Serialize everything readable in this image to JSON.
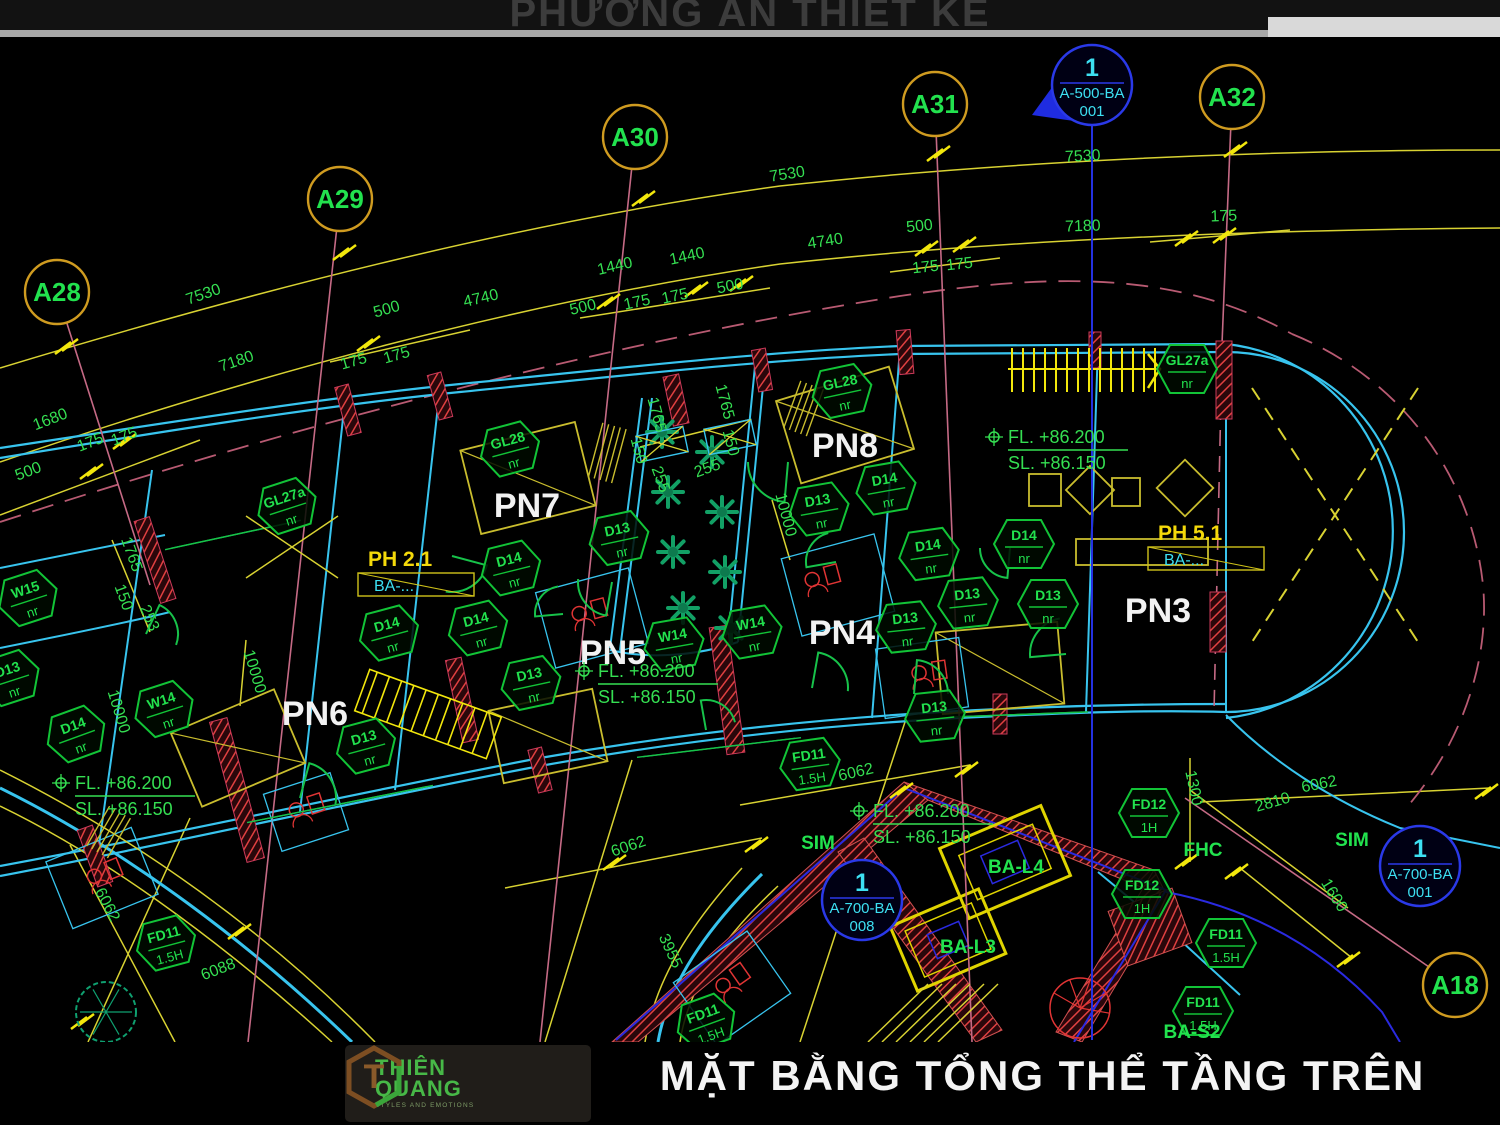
{
  "header": {
    "title": "PHƯƠNG ÁN THIẾT KẾ"
  },
  "footer": {
    "brand_line1": "THIÊN",
    "brand_line2": "QUANG",
    "tagline": "STYLES AND EMOTIONS",
    "monogram": "T",
    "title": "MẶT BẰNG TỔNG THỂ TẦNG TRÊN"
  },
  "colors": {
    "bg": "#000000",
    "green": "#22e24e",
    "dimGreen": "#35df52",
    "yellow": "#d8d232",
    "brightYellow": "#f2e70c",
    "cyanWall": "#38c4ee",
    "blue": "#2431e0",
    "cyanText": "#3de0f2",
    "pink": "#c56a85",
    "red": "#e03434",
    "white": "#f2f2f2",
    "bubble": "#cf9b20",
    "hex": "#12c437",
    "phYellow": "#f4d90a",
    "plant": "#12a065",
    "furn": "#c9bd2e"
  },
  "plan": {
    "grid_bubbles": [
      {
        "label": "A28",
        "x": 57,
        "y": 292
      },
      {
        "label": "A29",
        "x": 340,
        "y": 199
      },
      {
        "label": "A30",
        "x": 635,
        "y": 137
      },
      {
        "label": "A31",
        "x": 935,
        "y": 104
      },
      {
        "label": "A32",
        "x": 1232,
        "y": 97
      },
      {
        "label": "A18",
        "x": 1455,
        "y": 985
      }
    ],
    "section_markers": [
      {
        "type": "flag",
        "num": "1",
        "sheet": "A-500-BA",
        "ref": "001",
        "x": 1092,
        "y": 85
      },
      {
        "type": "circle",
        "num": "1",
        "sheet": "A-700-BA",
        "ref": "008",
        "x": 862,
        "y": 900
      },
      {
        "type": "circle",
        "num": "1",
        "sheet": "A-700-BA",
        "ref": "001",
        "x": 1420,
        "y": 866
      }
    ],
    "rooms": [
      {
        "label": "PN7",
        "x": 527,
        "y": 517
      },
      {
        "label": "PN8",
        "x": 845,
        "y": 457
      },
      {
        "label": "PN5",
        "x": 613,
        "y": 664
      },
      {
        "label": "PN4",
        "x": 842,
        "y": 644
      },
      {
        "label": "PN3",
        "x": 1158,
        "y": 622
      },
      {
        "label": "PN6",
        "x": 315,
        "y": 725
      }
    ],
    "levels": [
      {
        "x": 1008,
        "y": 443,
        "fl": "FL.  +86.200",
        "sl": "SL.  +86.150"
      },
      {
        "x": 598,
        "y": 677,
        "fl": "FL.  +86.200",
        "sl": "SL.  +86.150"
      },
      {
        "x": 75,
        "y": 789,
        "fl": "FL.  +86.200",
        "sl": "SL.  +86.150"
      },
      {
        "x": 873,
        "y": 817,
        "fl": "FL.  +86.200",
        "sl": "SL.  +86.150"
      }
    ],
    "ph_labels": [
      {
        "label": "PH 2.1",
        "sub": "BA-...",
        "x": 368,
        "y": 566
      },
      {
        "label": "PH 5.1",
        "sub": "BA-...",
        "x": 1158,
        "y": 540
      }
    ],
    "tags": [
      {
        "code": "GL28",
        "sub": "nr",
        "x": 510,
        "y": 449,
        "r": -15
      },
      {
        "code": "GL28",
        "sub": "nr",
        "x": 842,
        "y": 391,
        "r": -12
      },
      {
        "code": "GL27a",
        "sub": "nr",
        "x": 287,
        "y": 506,
        "r": -18
      },
      {
        "code": "GL27a",
        "sub": "nr",
        "x": 1187,
        "y": 369,
        "r": 0
      },
      {
        "code": "W15",
        "sub": "nr",
        "x": 28,
        "y": 598,
        "r": -18
      },
      {
        "code": "D13",
        "sub": "nr",
        "x": 10,
        "y": 678,
        "r": -18
      },
      {
        "code": "D14",
        "sub": "nr",
        "x": 76,
        "y": 734,
        "r": -20
      },
      {
        "code": "W14",
        "sub": "nr",
        "x": 164,
        "y": 709,
        "r": -18
      },
      {
        "code": "D13",
        "sub": "nr",
        "x": 366,
        "y": 746,
        "r": -15
      },
      {
        "code": "D14",
        "sub": "nr",
        "x": 389,
        "y": 633,
        "r": -15
      },
      {
        "code": "D14",
        "sub": "nr",
        "x": 478,
        "y": 628,
        "r": -14
      },
      {
        "code": "D13",
        "sub": "nr",
        "x": 531,
        "y": 683,
        "r": -12
      },
      {
        "code": "D14",
        "sub": "nr",
        "x": 511,
        "y": 568,
        "r": -14
      },
      {
        "code": "D13",
        "sub": "nr",
        "x": 619,
        "y": 538,
        "r": -12
      },
      {
        "code": "W14",
        "sub": "nr",
        "x": 674,
        "y": 644,
        "r": -10
      },
      {
        "code": "W14",
        "sub": "nr",
        "x": 752,
        "y": 632,
        "r": -10
      },
      {
        "code": "D13",
        "sub": "nr",
        "x": 906,
        "y": 627,
        "r": -6
      },
      {
        "code": "D13",
        "sub": "nr",
        "x": 968,
        "y": 603,
        "r": -6
      },
      {
        "code": "D13",
        "sub": "nr",
        "x": 1048,
        "y": 604,
        "r": 0
      },
      {
        "code": "D13",
        "sub": "nr",
        "x": 935,
        "y": 716,
        "r": -6
      },
      {
        "code": "D13",
        "sub": "nr",
        "x": 819,
        "y": 509,
        "r": -10
      },
      {
        "code": "D14",
        "sub": "nr",
        "x": 886,
        "y": 488,
        "r": -10
      },
      {
        "code": "D14",
        "sub": "nr",
        "x": 929,
        "y": 554,
        "r": -8
      },
      {
        "code": "D14",
        "sub": "nr",
        "x": 1024,
        "y": 544,
        "r": 0
      },
      {
        "code": "FD11",
        "sub": "1.5H",
        "x": 810,
        "y": 764,
        "r": -8
      },
      {
        "code": "FD11",
        "sub": "1.5H",
        "x": 166,
        "y": 943,
        "r": -15
      },
      {
        "code": "FD11",
        "sub": "1.5H",
        "x": 706,
        "y": 1022,
        "r": -20
      },
      {
        "code": "FD11",
        "sub": "1.5H",
        "x": 1226,
        "y": 943,
        "r": 0
      },
      {
        "code": "FD11",
        "sub": "1.5H",
        "x": 1203,
        "y": 1011,
        "r": 0
      },
      {
        "code": "FD12",
        "sub": "1H",
        "x": 1149,
        "y": 813,
        "r": 0
      },
      {
        "code": "FD12",
        "sub": "1H",
        "x": 1142,
        "y": 894,
        "r": 0
      }
    ],
    "dims": [
      {
        "t": "7530",
        "x": 205,
        "y": 299,
        "r": -19
      },
      {
        "t": "7180",
        "x": 238,
        "y": 366,
        "r": -19
      },
      {
        "t": "1680",
        "x": 52,
        "y": 424,
        "r": -21
      },
      {
        "t": "175",
        "x": 92,
        "y": 447,
        "r": -21
      },
      {
        "t": "175",
        "x": 126,
        "y": 441,
        "r": -21
      },
      {
        "t": "500",
        "x": 30,
        "y": 476,
        "r": -21
      },
      {
        "t": "500",
        "x": 388,
        "y": 314,
        "r": -16
      },
      {
        "t": "175",
        "x": 355,
        "y": 366,
        "r": -16
      },
      {
        "t": "175",
        "x": 398,
        "y": 360,
        "r": -16
      },
      {
        "t": "4740",
        "x": 482,
        "y": 303,
        "r": -13
      },
      {
        "t": "7530",
        "x": 788,
        "y": 179,
        "r": -9
      },
      {
        "t": "1440",
        "x": 616,
        "y": 271,
        "r": -13
      },
      {
        "t": "1440",
        "x": 688,
        "y": 261,
        "r": -12
      },
      {
        "t": "500",
        "x": 584,
        "y": 312,
        "r": -13
      },
      {
        "t": "500",
        "x": 731,
        "y": 291,
        "r": -11
      },
      {
        "t": "175",
        "x": 638,
        "y": 307,
        "r": -12
      },
      {
        "t": "175",
        "x": 676,
        "y": 301,
        "r": -12
      },
      {
        "t": "4740",
        "x": 826,
        "y": 246,
        "r": -9
      },
      {
        "t": "500",
        "x": 920,
        "y": 231,
        "r": -6
      },
      {
        "t": "175",
        "x": 926,
        "y": 272,
        "r": -6
      },
      {
        "t": "175",
        "x": 960,
        "y": 269,
        "r": -6
      },
      {
        "t": "7530",
        "x": 1083,
        "y": 161,
        "r": -3
      },
      {
        "t": "7180",
        "x": 1083,
        "y": 231,
        "r": -2
      },
      {
        "t": "175",
        "x": 1224,
        "y": 221,
        "r": -2
      },
      {
        "t": "1765",
        "x": 127,
        "y": 556,
        "r": 70
      },
      {
        "t": "150",
        "x": 119,
        "y": 599,
        "r": 70
      },
      {
        "t": "253",
        "x": 145,
        "y": 620,
        "r": 66
      },
      {
        "t": "1765",
        "x": 652,
        "y": 416,
        "r": 75
      },
      {
        "t": "1765",
        "x": 720,
        "y": 403,
        "r": 75
      },
      {
        "t": "150",
        "x": 634,
        "y": 452,
        "r": 75
      },
      {
        "t": "150",
        "x": 726,
        "y": 444,
        "r": 75
      },
      {
        "t": "255",
        "x": 656,
        "y": 481,
        "r": 70
      },
      {
        "t": "255",
        "x": 709,
        "y": 473,
        "r": -20
      },
      {
        "t": "10000",
        "x": 250,
        "y": 673,
        "r": 73
      },
      {
        "t": "10000",
        "x": 114,
        "y": 713,
        "r": 73
      },
      {
        "t": "10000",
        "x": 781,
        "y": 516,
        "r": 75
      },
      {
        "t": "6062",
        "x": 857,
        "y": 777,
        "r": -13
      },
      {
        "t": "6062",
        "x": 630,
        "y": 851,
        "r": -19
      },
      {
        "t": "6062",
        "x": 103,
        "y": 907,
        "r": 62
      },
      {
        "t": "6088",
        "x": 220,
        "y": 974,
        "r": -21
      },
      {
        "t": "3955",
        "x": 666,
        "y": 953,
        "r": 65
      },
      {
        "t": "6062",
        "x": 1320,
        "y": 789,
        "r": -11
      },
      {
        "t": "2810",
        "x": 1274,
        "y": 807,
        "r": -16
      },
      {
        "t": "1300",
        "x": 1189,
        "y": 789,
        "r": 78
      },
      {
        "t": "1600",
        "x": 1330,
        "y": 898,
        "r": 58
      }
    ],
    "misc": [
      {
        "t": "SIM",
        "x": 818,
        "y": 849
      },
      {
        "t": "SIM",
        "x": 1352,
        "y": 846
      },
      {
        "t": "FHC",
        "x": 1203,
        "y": 856
      },
      {
        "t": "BA-L4",
        "x": 1016,
        "y": 873
      },
      {
        "t": "BA-L3",
        "x": 968,
        "y": 953
      },
      {
        "t": "BA-S2",
        "x": 1192,
        "y": 1038
      }
    ],
    "decor": {
      "stems": [
        [
          57,
          292,
          150,
          585,
          0
        ],
        [
          340,
          199,
          248,
          1042,
          0
        ],
        [
          635,
          137,
          540,
          1042,
          0
        ],
        [
          935,
          104,
          972,
          1042,
          0
        ],
        [
          1232,
          97,
          1222,
          344,
          0
        ],
        [
          1455,
          985,
          1185,
          798,
          0
        ],
        [
          1222,
          352,
          1214,
          712,
          1
        ]
      ],
      "ticks": [
        [
          70,
          345
        ],
        [
          348,
          251
        ],
        [
          647,
          197
        ],
        [
          942,
          152
        ],
        [
          1239,
          148
        ],
        [
          128,
          440
        ],
        [
          372,
          342
        ],
        [
          612,
          300
        ],
        [
          700,
          288
        ],
        [
          745,
          282
        ],
        [
          930,
          247
        ],
        [
          968,
          243
        ],
        [
          1190,
          237
        ],
        [
          1228,
          234
        ],
        [
          95,
          470
        ],
        [
          618,
          861
        ],
        [
          905,
          789
        ],
        [
          760,
          843
        ],
        [
          970,
          768
        ],
        [
          243,
          930
        ],
        [
          86,
          1020
        ],
        [
          1240,
          870
        ],
        [
          1352,
          958
        ],
        [
          1190,
          860
        ],
        [
          1490,
          790
        ]
      ],
      "columns": [
        [
          155,
          560,
          16,
          86,
          -18
        ],
        [
          348,
          410,
          14,
          50,
          -15
        ],
        [
          440,
          396,
          14,
          46,
          -15
        ],
        [
          676,
          400,
          16,
          50,
          -12
        ],
        [
          762,
          370,
          14,
          42,
          -10
        ],
        [
          905,
          352,
          14,
          44,
          -5
        ],
        [
          1095,
          350,
          12,
          36,
          0
        ],
        [
          1224,
          380,
          16,
          78,
          0
        ],
        [
          1218,
          622,
          16,
          60,
          0
        ],
        [
          237,
          790,
          18,
          145,
          -15
        ],
        [
          727,
          690,
          18,
          128,
          -8
        ],
        [
          95,
          856,
          16,
          60,
          -20
        ],
        [
          462,
          700,
          16,
          84,
          -12
        ],
        [
          540,
          770,
          14,
          44,
          -14
        ],
        [
          1000,
          714,
          14,
          40,
          0
        ]
      ],
      "furniture": [
        [
          528,
          478,
          118,
          86,
          -14,
          1
        ],
        [
          845,
          425,
          118,
          86,
          -17,
          1
        ],
        [
          1000,
          668,
          122,
          82,
          -5,
          1
        ],
        [
          238,
          748,
          112,
          80,
          -23,
          1
        ],
        [
          548,
          736,
          106,
          74,
          -12,
          1
        ],
        [
          1142,
          552,
          132,
          26,
          0,
          0
        ],
        [
          1045,
          490,
          32,
          32,
          0,
          0
        ],
        [
          1090,
          490,
          34,
          34,
          45,
          0
        ],
        [
          1126,
          492,
          28,
          28,
          0,
          0
        ],
        [
          1185,
          488,
          40,
          40,
          45,
          0
        ]
      ],
      "baths": [
        [
          592,
          618,
          96,
          78,
          -15
        ],
        [
          838,
          585,
          96,
          80,
          -15
        ],
        [
          922,
          678,
          84,
          70,
          -8
        ],
        [
          102,
          878,
          92,
          72,
          -22
        ],
        [
          732,
          988,
          90,
          76,
          -35
        ],
        [
          306,
          812,
          70,
          60,
          -18
        ]
      ],
      "fixtures": [
        [
          585,
          612,
          -15
        ],
        [
          818,
          578,
          -15
        ],
        [
          925,
          672,
          -8
        ],
        [
          100,
          874,
          -22
        ],
        [
          728,
          982,
          -35
        ],
        [
          302,
          808,
          -18
        ]
      ],
      "doors": [
        [
          452,
          556,
          36,
          15
        ],
        [
          612,
          582,
          34,
          100
        ],
        [
          788,
          462,
          40,
          95
        ],
        [
          812,
          688,
          36,
          -80
        ],
        [
          914,
          694,
          34,
          -85
        ],
        [
          1066,
          654,
          36,
          175
        ],
        [
          300,
          798,
          36,
          -75
        ],
        [
          146,
          634,
          32,
          -65
        ],
        [
          706,
          730,
          30,
          -100
        ],
        [
          836,
          562,
          30,
          170
        ],
        [
          563,
          614,
          28,
          175
        ],
        [
          1010,
          548,
          30,
          95
        ]
      ],
      "windows": [
        [
          250,
          822,
          430,
          786
        ],
        [
          640,
          757,
          798,
          738
        ],
        [
          953,
          717,
          1085,
          712
        ],
        [
          168,
          549,
          298,
          521
        ]
      ],
      "flowers": [
        [
          662,
          432
        ],
        [
          712,
          452
        ],
        [
          668,
          492
        ],
        [
          722,
          512
        ],
        [
          673,
          552
        ],
        [
          725,
          572
        ],
        [
          683,
          608
        ],
        [
          731,
          628
        ]
      ],
      "tree": [
        106,
        1012,
        30
      ],
      "combs": [
        [
          600,
          480,
          -75,
          56
        ],
        [
          795,
          432,
          -70,
          50
        ],
        [
          97,
          852,
          -60,
          46
        ]
      ],
      "pergola": [
        [
          662,
          444
        ],
        [
          730,
          437
        ]
      ],
      "xmarks": [
        [
          1252,
          388,
          1418,
          642,
          1
        ],
        [
          1418,
          388,
          1252,
          642,
          1
        ],
        [
          246,
          516,
          338,
          578,
          0
        ],
        [
          338,
          516,
          246,
          578,
          0
        ]
      ],
      "stair_h": [
        1008,
        346,
        152,
        46
      ],
      "stair_r": [
        428,
        714,
        -70,
        44,
        140
      ],
      "spiral": [
        1080,
        1008,
        30
      ],
      "steps": [
        868,
        1042,
        6
      ]
    }
  }
}
